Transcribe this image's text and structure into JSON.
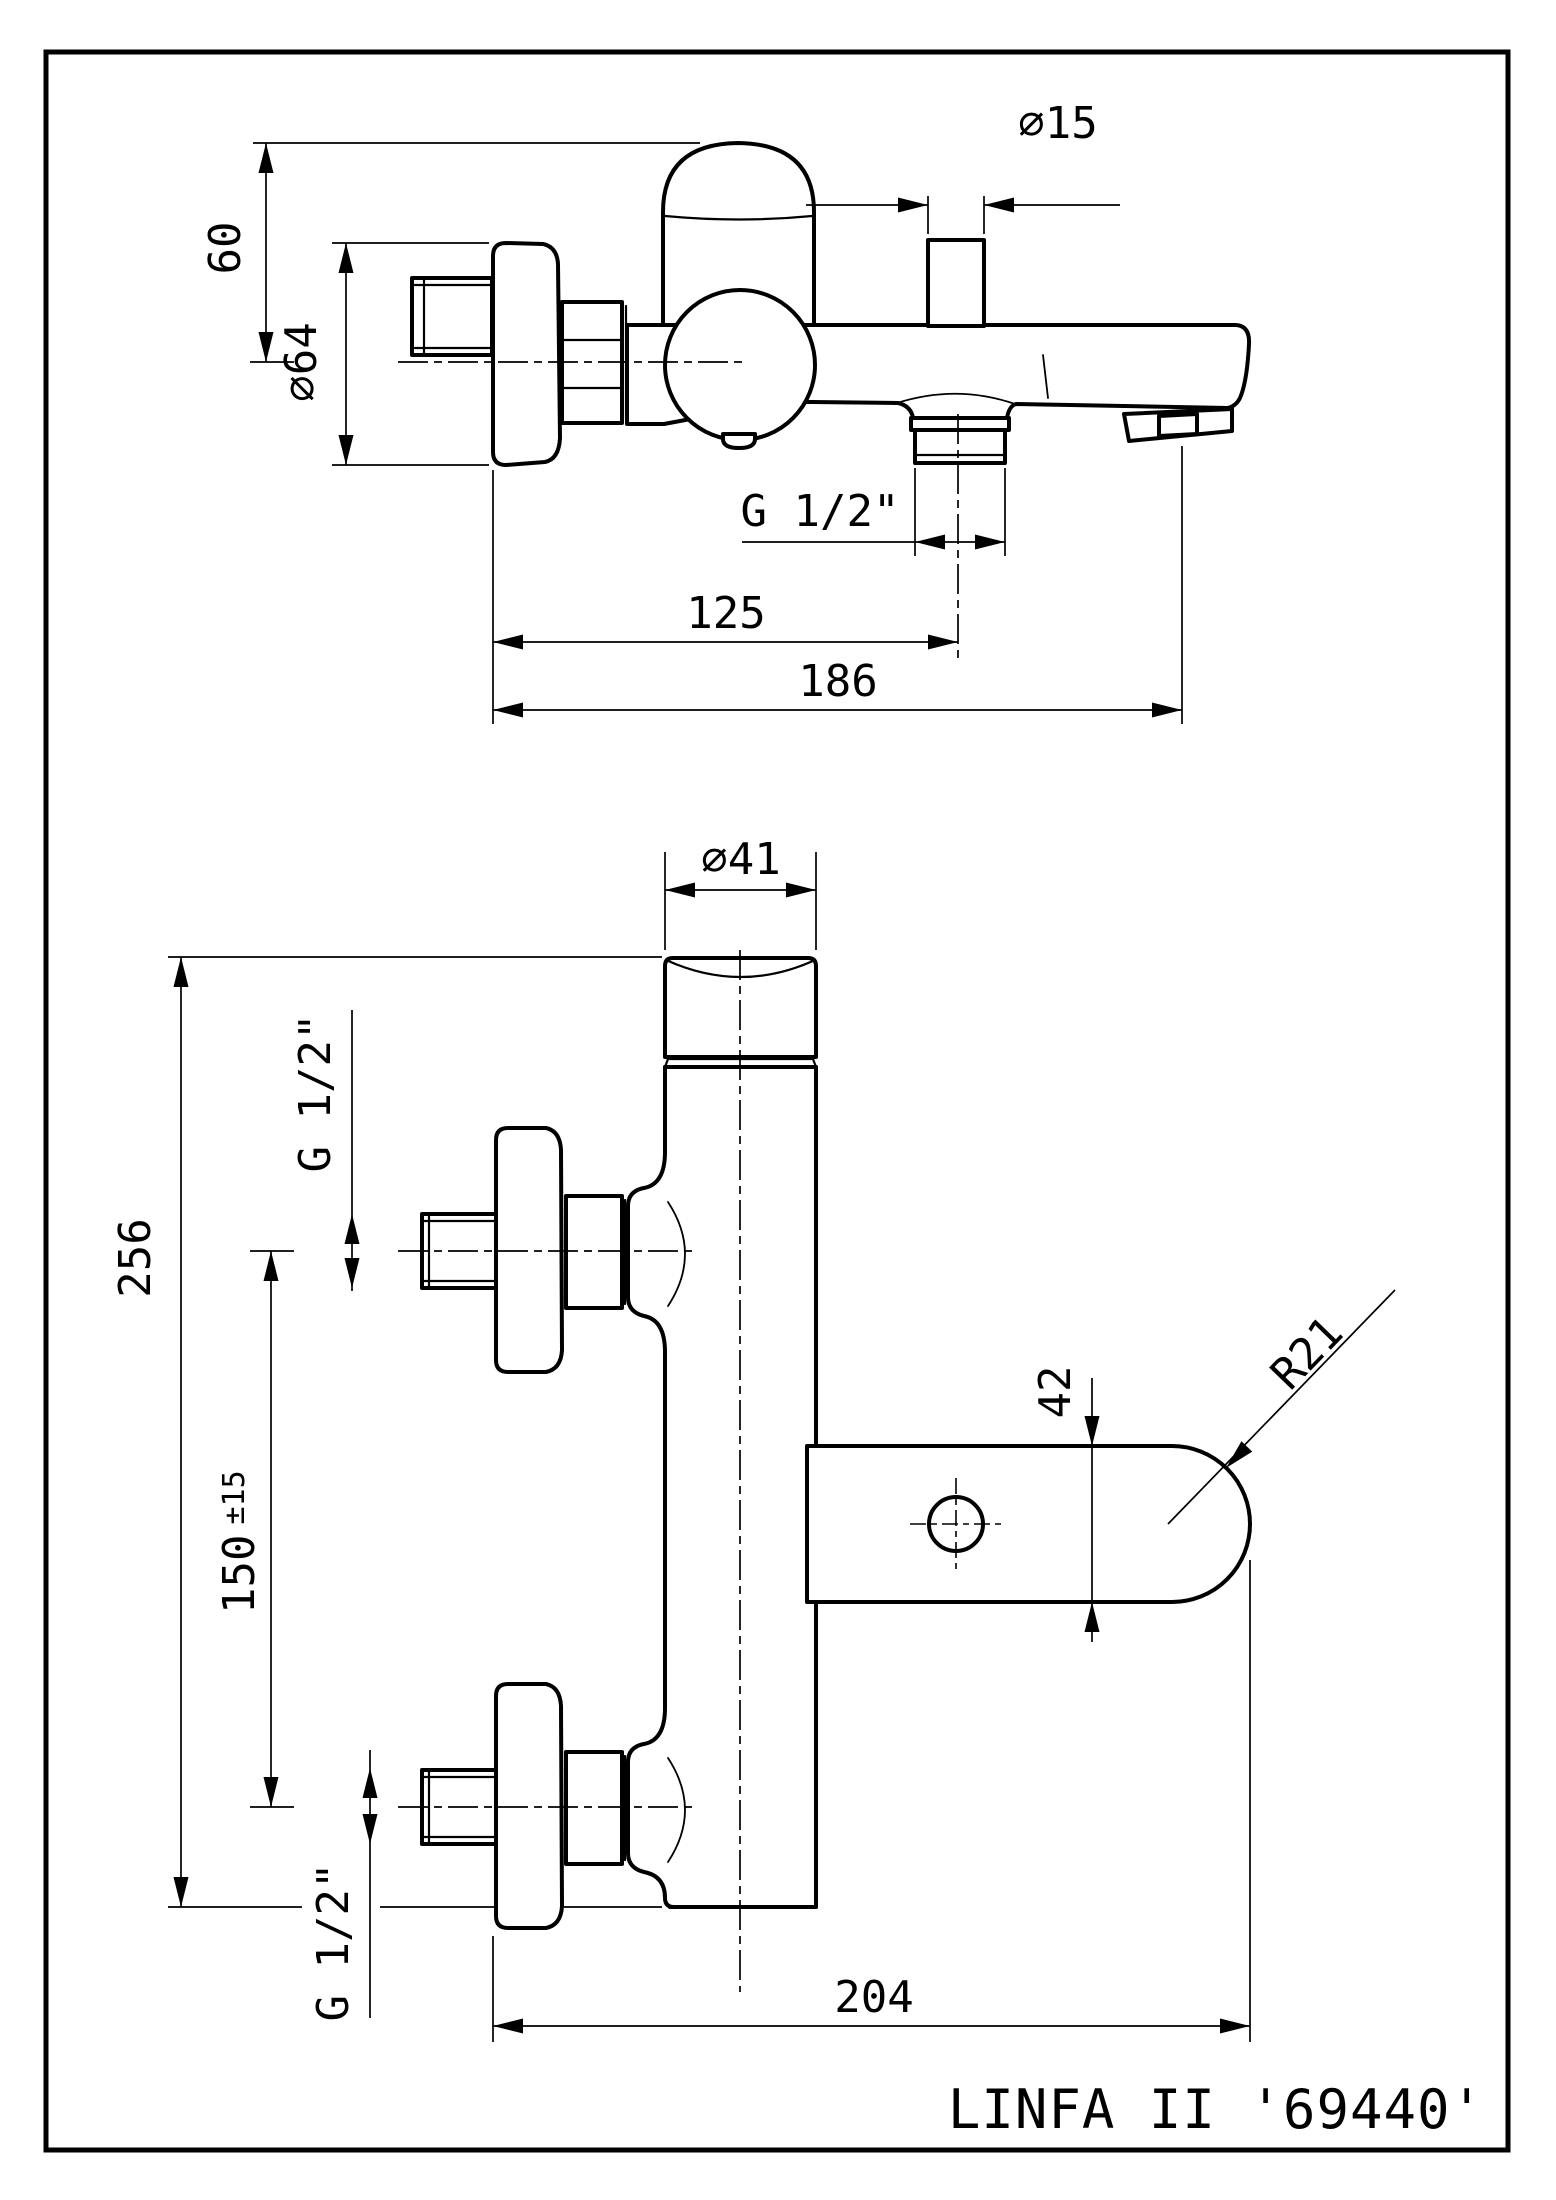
{
  "page": {
    "background": "#ffffff",
    "line_color": "#000000"
  },
  "title": {
    "text": "LINFA II '69440'"
  },
  "side_view": {
    "dim_60": "60",
    "dim_dia64": "∅64",
    "dim_dia15": "∅15",
    "dim_thread_outlet": "G 1/2\"",
    "dim_125": "125",
    "dim_186": "186"
  },
  "front_view": {
    "dim_dia41": "∅41",
    "dim_thread_inlet_top": "G 1/2\"",
    "dim_256": "256",
    "dim_150": "150",
    "dim_150_tol": "±15",
    "dim_42": "42",
    "dim_r21": "R21",
    "dim_thread_inlet_bottom": "G 1/2\"",
    "dim_204": "204"
  }
}
